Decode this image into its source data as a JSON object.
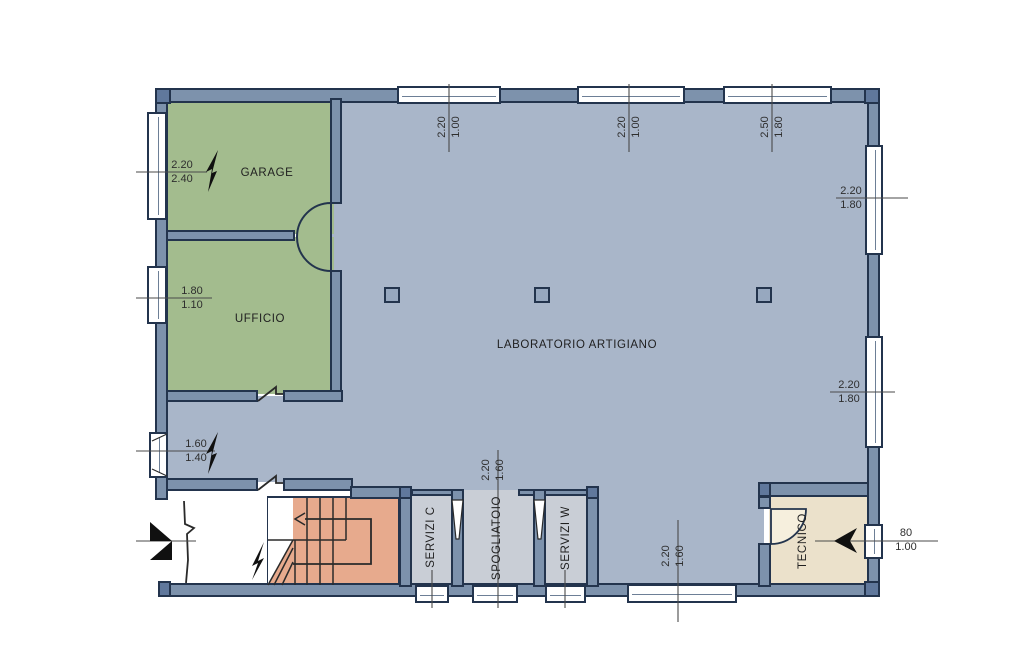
{
  "rooms": [
    {
      "id": "garage",
      "label": "GARAGE"
    },
    {
      "id": "ufficio",
      "label": "UFFICIO"
    },
    {
      "id": "laboratorio",
      "label": "LABORATORIO ARTIGIANO"
    },
    {
      "id": "servizi-c",
      "label": "SERVIZI C"
    },
    {
      "id": "spogliatoio",
      "label": "SPOGLIATOIO"
    },
    {
      "id": "servizi-w",
      "label": "SERVIZI W"
    },
    {
      "id": "tecnico",
      "label": "TECNICO"
    }
  ],
  "dimensions": [
    {
      "id": "garage-window",
      "width": "2.20",
      "height": "2.40"
    },
    {
      "id": "ufficio-window",
      "width": "1.80",
      "height": "1.10"
    },
    {
      "id": "lab-side-door",
      "width": "1.60",
      "height": "1.40"
    },
    {
      "id": "top-window-1",
      "width": "2.20",
      "height": "1.00"
    },
    {
      "id": "top-window-2",
      "width": "2.20",
      "height": "1.00"
    },
    {
      "id": "top-window-3",
      "width": "2.50",
      "height": "1.80"
    },
    {
      "id": "right-window-1",
      "width": "2.20",
      "height": "1.80"
    },
    {
      "id": "right-window-2",
      "width": "2.20",
      "height": "1.80"
    },
    {
      "id": "spogliatoio-opening",
      "width": "2.20",
      "height": "1.60"
    },
    {
      "id": "bottom-window",
      "width": "2.20",
      "height": "1.60"
    },
    {
      "id": "tecnico-vent",
      "width": "80",
      "height": "1.00"
    }
  ],
  "colors": {
    "wall": "#7d92ac",
    "line": "#23344d",
    "lab_floor": "#a9b6c9",
    "green_floor": "#a3bc8e",
    "stairs_floor": "#e7aa8d",
    "tecnico_floor": "#ebe1cb",
    "service_floor": "#c9ced6",
    "block": "#60789c",
    "dim_text": "#2e2e2e"
  }
}
